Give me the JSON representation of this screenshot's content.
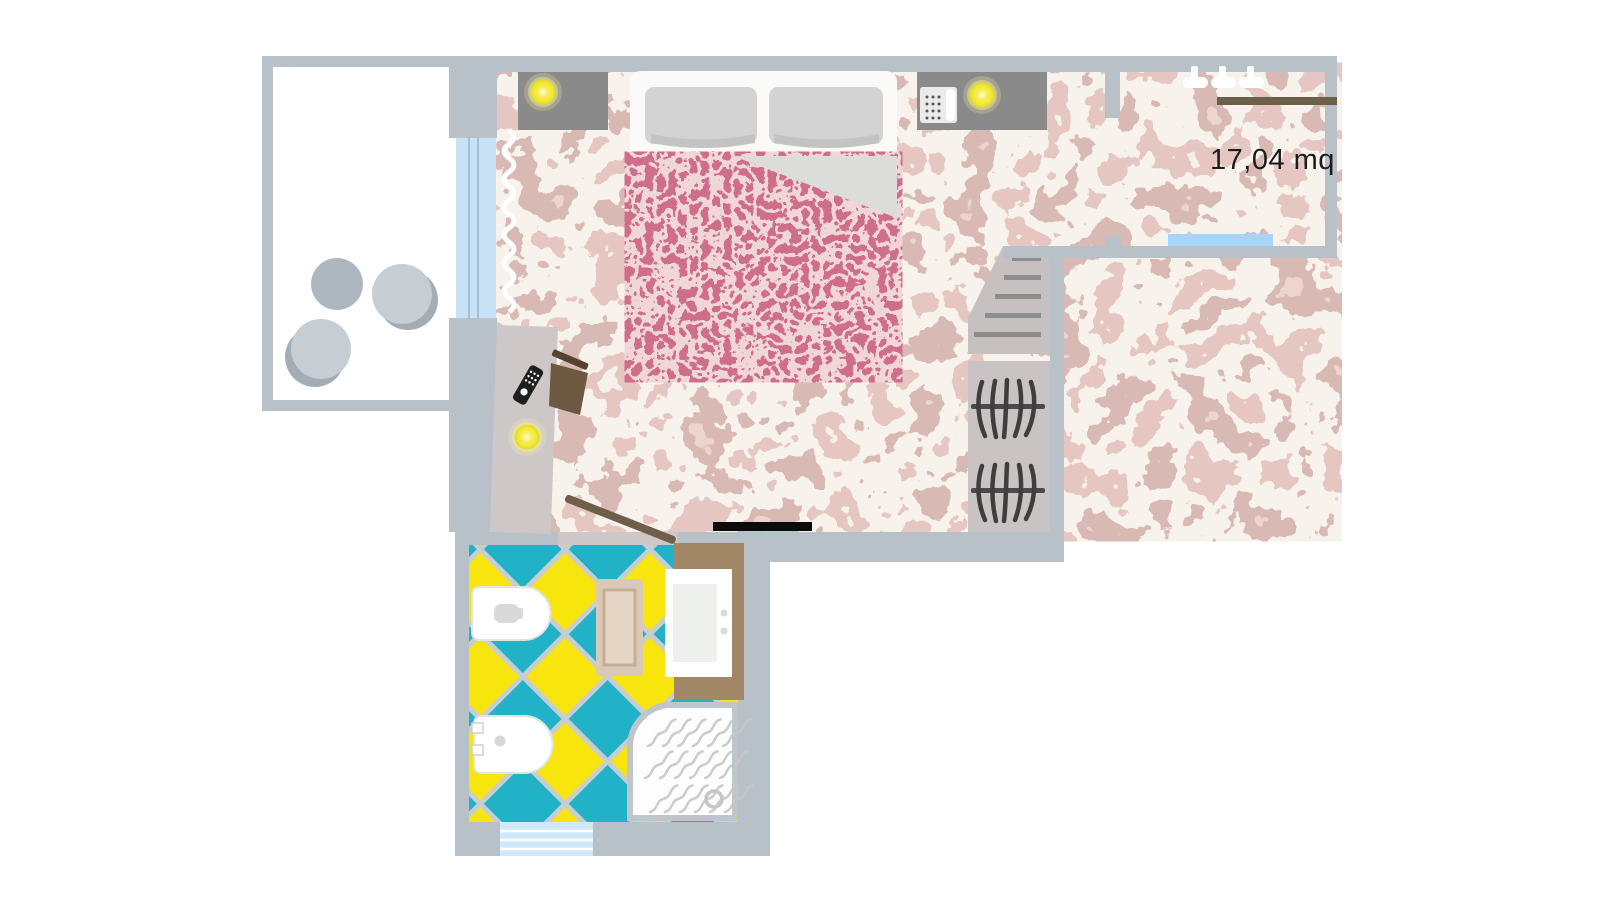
{
  "meta": {
    "type": "floor-plan",
    "title": "Hotel room floor plan"
  },
  "labels": {
    "area": "17,04 mq"
  },
  "rooms": {
    "bedroom": "bedroom",
    "bathroom": "bathroom",
    "balcony": "balcony",
    "closet_corridor": "wardrobe corridor"
  },
  "objects": [
    "double-bed",
    "pillows",
    "red-blanket",
    "nightstand-left",
    "nightstand-right",
    "bedside-lamp-left",
    "bedside-lamp-right",
    "telephone",
    "desk",
    "desk-chair",
    "remote-control",
    "floor-lamp",
    "curtain",
    "balcony-window",
    "corridor-window",
    "bathroom-window",
    "balcony-table",
    "balcony-chairs",
    "shelf-steps",
    "clothes-hangers",
    "coat-hooks",
    "clothes-rail",
    "entrance-bar",
    "bathroom-door",
    "toilet",
    "bidet",
    "bath-mat",
    "sink-vanity",
    "shower"
  ],
  "colors": {
    "wall": "#b8c1c8",
    "floor_marble_pink": "#c89088",
    "floor_marble_cream": "#eee4d7",
    "floor_marble_mauve": "#b27c74",
    "blanket_red": "#a02841",
    "blanket_pattern": "#e2acb1",
    "tile_teal": "#22b2c7",
    "tile_yellow": "#f8e50e",
    "tile_grout": "#c7ced2",
    "window_blue": "#a5d6fa",
    "vanity_brown": "#a28767",
    "lamp_yellow": "#f3e93c",
    "nightstand_gray": "#8a8a8a",
    "door_brown": "#6f5e49"
  }
}
